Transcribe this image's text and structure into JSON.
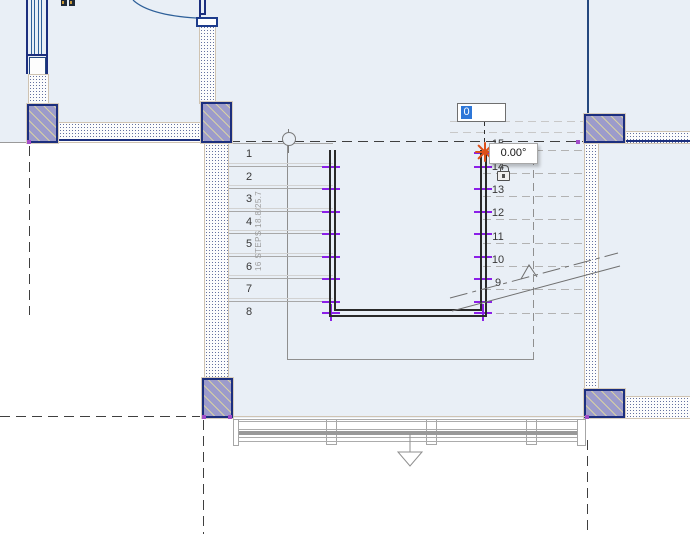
{
  "view": {
    "background_color": "#FFFFFF",
    "room_fill_color": "#E9EFF6"
  },
  "stair": {
    "annotation_label": "16 STEPS 18.8/25.7",
    "left_run_numbers": [
      "1",
      "2",
      "3",
      "4",
      "5",
      "6",
      "7",
      "8"
    ],
    "right_run_numbers": [
      "9",
      "10",
      "11",
      "12",
      "13",
      "14",
      "15"
    ]
  },
  "edit_controls": {
    "dimension_input_value": "0",
    "angle_tooltip_value": "0.00°"
  },
  "icons": {
    "lock": "lock-icon",
    "snap_marker": "snap-star-icon",
    "path_start": "path-start-circle-icon",
    "section_arrow": "section-arrow-icon"
  },
  "colors": {
    "selection_highlight": "#2E77D8",
    "snap_marker": "#DD5019",
    "selected_path_ticks": "#8B1FE8",
    "column_fill": "#9C9BCB",
    "wall_edge": "#1C2F7E"
  }
}
